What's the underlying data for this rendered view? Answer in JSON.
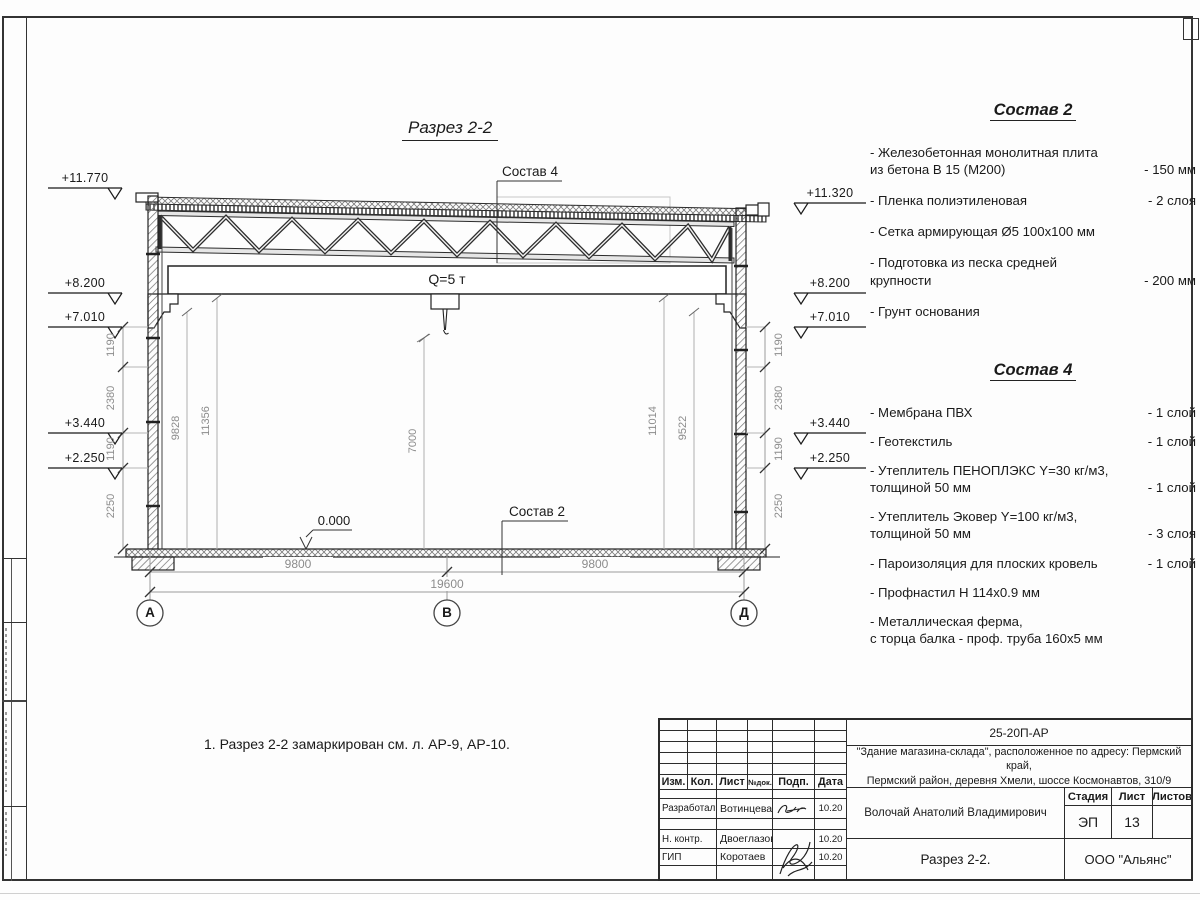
{
  "section": {
    "title": "Разрез 2-2",
    "crane_label": "Q=5 т",
    "zero_level": "0.000",
    "callout_roof": "Состав 4",
    "callout_floor": "Состав 2",
    "note": "1. Разрез 2-2 замаркирован см. л. АР-9, АР-10.",
    "axes": [
      "А",
      "В",
      "Д"
    ],
    "elevations_left": [
      "+11.770",
      "+8.200",
      "+7.010",
      "+3.440",
      "+2.250"
    ],
    "elevations_right": [
      "+11.320",
      "+8.200",
      "+7.010",
      "+3.440",
      "+2.250"
    ],
    "wall_dims": [
      "1190",
      "2380",
      "1190",
      "2250"
    ],
    "interior_dims": [
      "9828",
      "11356",
      "7000",
      "11014",
      "9522"
    ],
    "span_dims": [
      "9800",
      "9800"
    ],
    "total_dim": "19600"
  },
  "legend_2": {
    "title": "Состав 2",
    "items": [
      {
        "name": "- Железобетонная  монолитная плита\nиз бетона В 15 (М200)",
        "value": "- 150 мм"
      },
      {
        "name": "- Пленка полиэтиленовая",
        "value": "-  2 слоя"
      },
      {
        "name": "- Сетка армирующая Ø5 100х100 мм",
        "value": ""
      },
      {
        "name": "- Подготовка из песка средней\nкрупности",
        "value": "- 200 мм"
      },
      {
        "name": "- Грунт основания",
        "value": ""
      }
    ]
  },
  "legend_4": {
    "title": "Состав 4",
    "items": [
      {
        "name": "- Мембрана ПВХ",
        "value": "- 1 слой"
      },
      {
        "name": "- Геотекстиль",
        "value": "- 1 слой"
      },
      {
        "name": "- Утеплитель ПЕНОПЛЭКС Y=30 кг/м3,\nтолщиной 50 мм",
        "value": "- 1 слой"
      },
      {
        "name": "- Утеплитель Эковер Y=100 кг/м3,\nтолщиной 50 мм",
        "value": "- 3 слоя"
      },
      {
        "name": "- Пароизоляция для плоских кровель",
        "value": "- 1 слой"
      },
      {
        "name": "- Профнастил Н 114х0.9 мм",
        "value": ""
      },
      {
        "name": "- Металлическая ферма,\nс торца балка - проф. труба 160х5 мм",
        "value": ""
      }
    ]
  },
  "title_block": {
    "code": "25-20П-АР",
    "project": "\"Здание магазина-склада\", расположенное по адресу: Пермский край,\nПермский район, деревня Хмели, шоссе Космонавтов, 310/9",
    "col_izm": "Изм.",
    "col_kol": "Кол.",
    "col_list": "Лист",
    "col_ndok": "№док.",
    "col_podp": "Подп.",
    "col_data": "Дата",
    "row1_role": "Разработал",
    "row1_name": "Вотинцева",
    "row1_date": "10.20",
    "row2_role": "Н. контр.",
    "row2_name": "Двоеглазов",
    "row2_date": "10.20",
    "row3_role": "ГИП",
    "row3_name": "Коротаев",
    "row3_date": "10.20",
    "author": "Волочай Анатолий Владимирович",
    "stage_label": "Стадия",
    "sheet_label": "Лист",
    "sheets_label": "Листов",
    "stage": "ЭП",
    "sheet_no": "13",
    "sheets_total": "",
    "doc_title": "Разрез 2-2.",
    "company": "ООО \"Альянс\""
  }
}
